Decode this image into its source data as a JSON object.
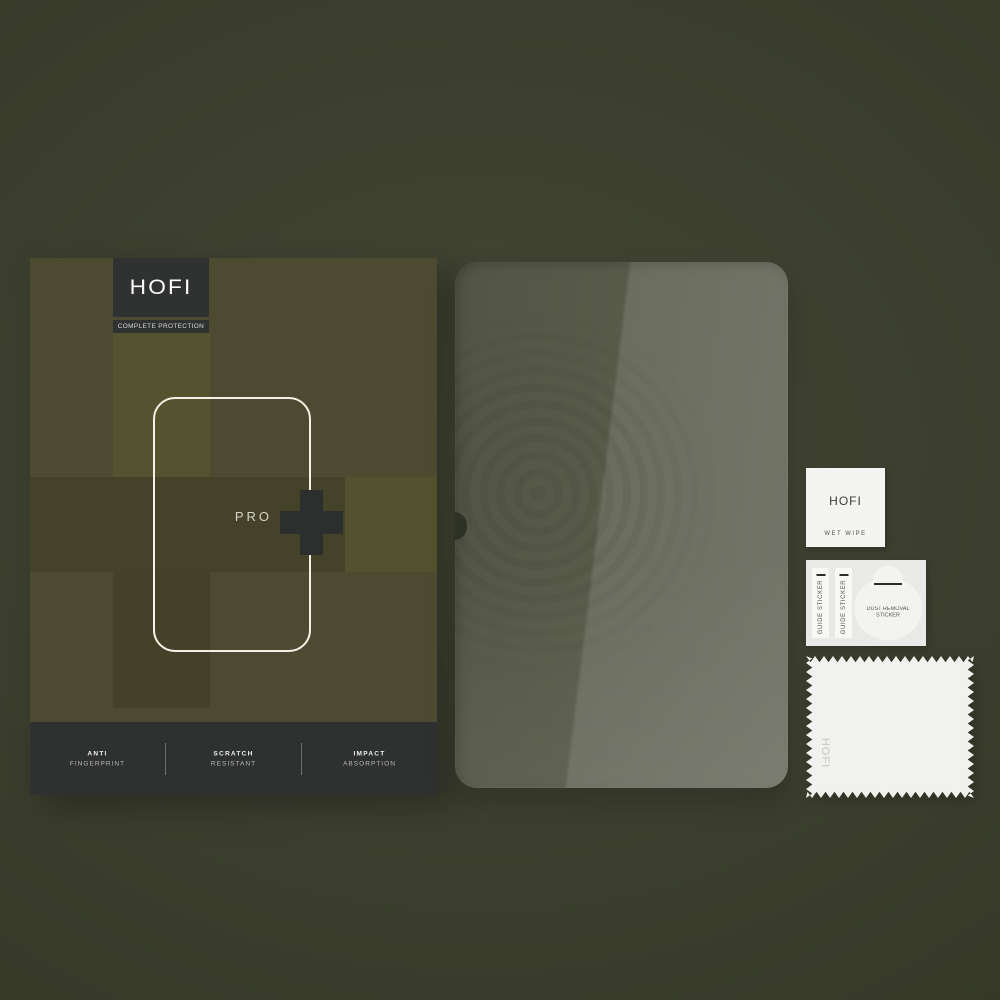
{
  "box": {
    "brand": "HOFI",
    "tagline": "COMPLETE PROTECTION",
    "model_label": "PRO",
    "features": [
      {
        "line1": "ANTI",
        "line2": "FINGERPRINT"
      },
      {
        "line1": "SCRATCH",
        "line2": "RESISTANT"
      },
      {
        "line1": "IMPACT",
        "line2": "ABSORPTION"
      }
    ]
  },
  "accessories": {
    "wet_wipe": {
      "brand": "HOFI",
      "label": "WET WIPE"
    },
    "sticker_sheet": {
      "guide_label": "GUIDE STICKER",
      "dust_line1": "DUST REMOVAL",
      "dust_line2": "STICKER"
    },
    "cloth": {
      "brand": "HOFI"
    }
  },
  "icons": {
    "plus": "plus-icon",
    "camera_notch": "camera-notch-cutout"
  },
  "colors": {
    "background": "#3b3e2e",
    "box_olive": "#4c4b31",
    "box_olive_light": "#54532f",
    "box_olive_dark": "#444329",
    "panel_charcoal": "#2e3130",
    "tablet_outline": "#f3f0e5",
    "glass_dark": "#565947",
    "glass_light": "#6f7165",
    "paper_white": "#f3f3f1"
  }
}
